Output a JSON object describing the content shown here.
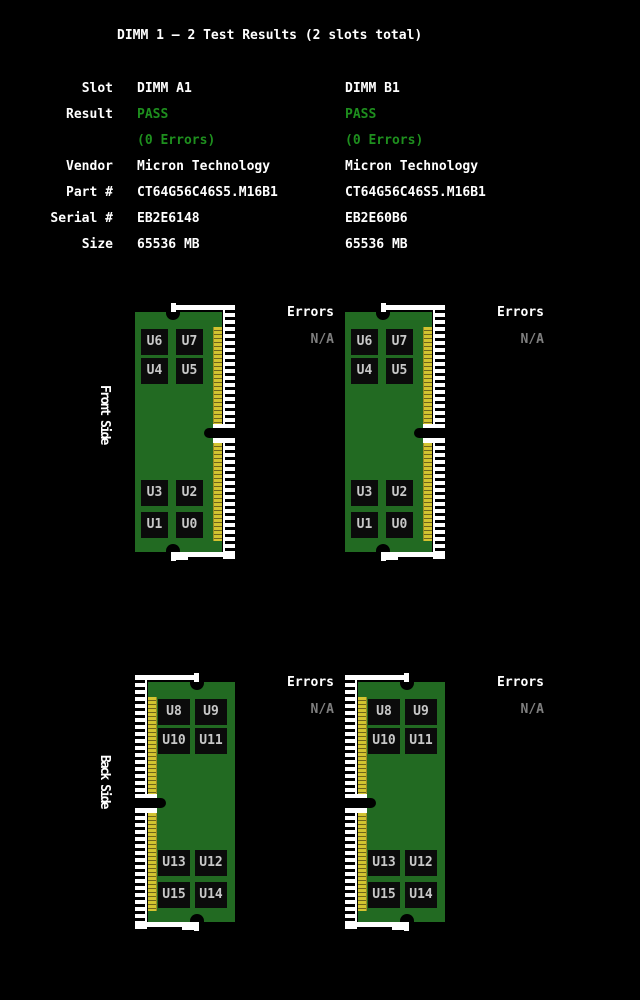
{
  "title": "DIMM 1 – 2 Test Results (2 slots total)",
  "colors": {
    "background": "#000000",
    "text_white": "#ffffff",
    "pass_green": "#1e8f1e",
    "na_gray": "#7f7f7f",
    "pcb_green": "#226a22",
    "gold": "#d2c430",
    "gold_separator": "#6e641c",
    "chip_black": "#0b0b0b",
    "chip_label_gray": "#c8c8c8",
    "socket_white": "#ffffff"
  },
  "info_table": {
    "rows": [
      {
        "label": "Slot",
        "a": "DIMM A1",
        "b": "DIMM B1",
        "green": false
      },
      {
        "label": "Result",
        "a": "PASS",
        "b": "PASS",
        "green": true
      },
      {
        "label": "",
        "a": "(0 Errors)",
        "b": "(0 Errors)",
        "green": true
      },
      {
        "label": "Vendor",
        "a": "Micron Technology",
        "b": "Micron Technology",
        "green": false
      },
      {
        "label": "Part #",
        "a": "CT64G56C46S5.M16B1",
        "b": "CT64G56C46S5.M16B1",
        "green": false
      },
      {
        "label": "Serial #",
        "a": "EB2E6148",
        "b": "EB2E60B6",
        "green": false
      },
      {
        "label": "Size",
        "a": "65536 MB",
        "b": "65536 MB",
        "green": false
      }
    ]
  },
  "sections": [
    {
      "side_label": "Front Side",
      "chip_labels": [
        [
          "U6",
          "U7"
        ],
        [
          "U4",
          "U5"
        ],
        [
          "U3",
          "U2"
        ],
        [
          "U1",
          "U0"
        ]
      ],
      "modules": [
        {
          "errors_label": "Errors",
          "errors_value": "N/A"
        },
        {
          "errors_label": "Errors",
          "errors_value": "N/A"
        }
      ]
    },
    {
      "side_label": "Back Side",
      "chip_labels": [
        [
          "U8",
          "U9"
        ],
        [
          "U10",
          "U11"
        ],
        [
          "U13",
          "U12"
        ],
        [
          "U15",
          "U14"
        ]
      ],
      "modules": [
        {
          "errors_label": "Errors",
          "errors_value": "N/A"
        },
        {
          "errors_label": "Errors",
          "errors_value": "N/A"
        }
      ]
    }
  ]
}
